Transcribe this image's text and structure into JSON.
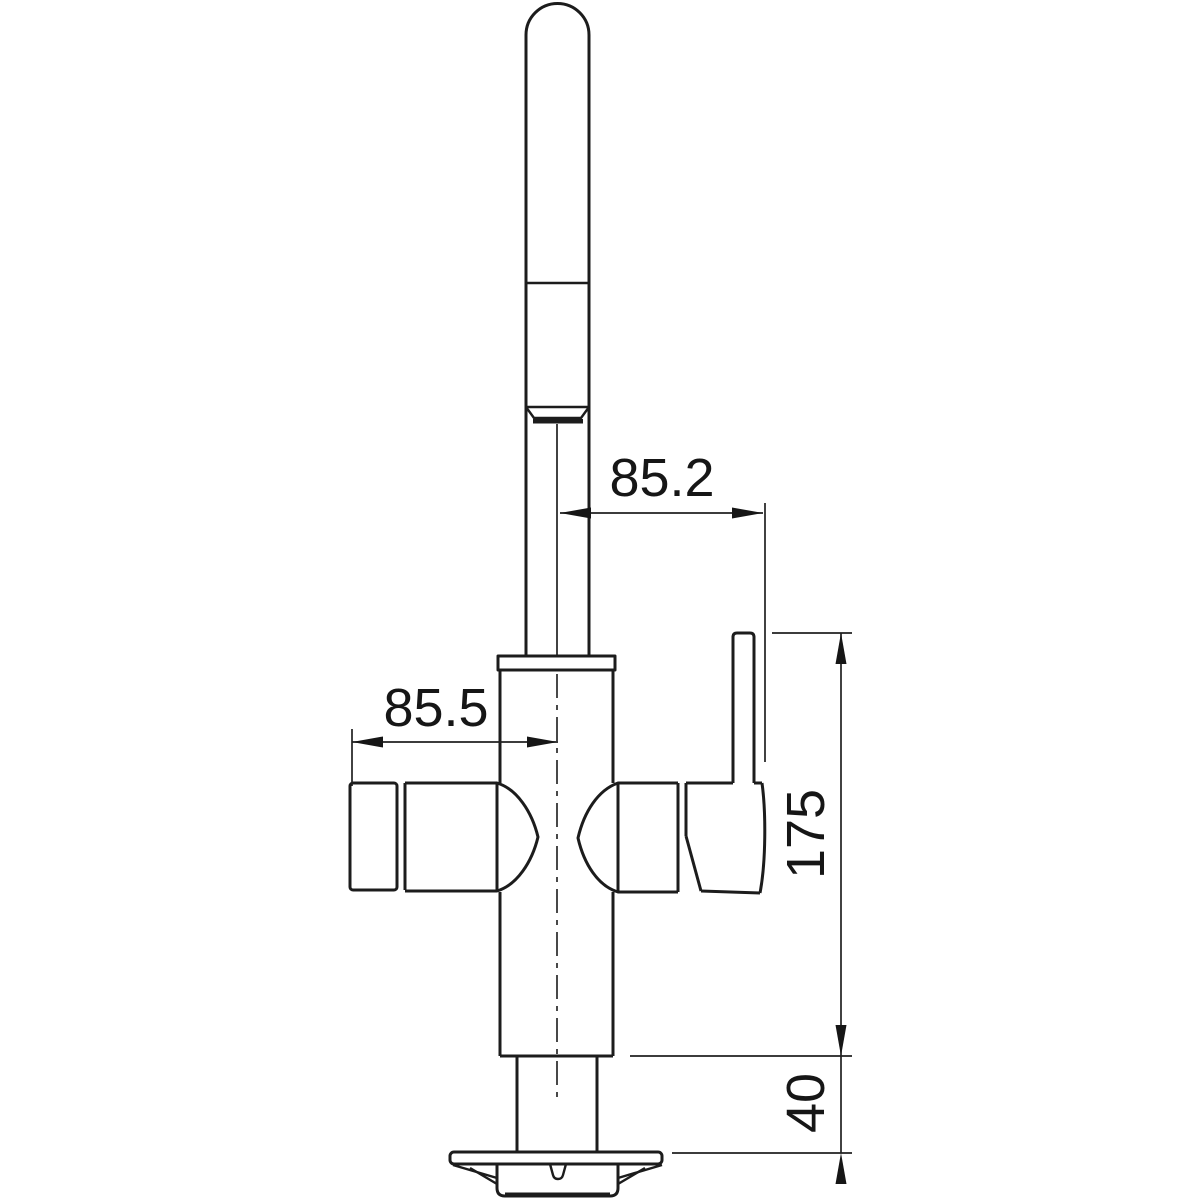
{
  "page": {
    "background": "#ffffff"
  },
  "drawing": {
    "kind": "technical-dimension-drawing",
    "subject": "single-lever kitchen tap, side elevation",
    "line_color": "#1c1c1c",
    "text_color": "#161616",
    "units_shown": false,
    "dimensions": [
      {
        "id": "offset-spout-to-lever",
        "label": "85.2",
        "orientation": "horizontal"
      },
      {
        "id": "offset-valve-to-center",
        "label": "85.5",
        "orientation": "horizontal"
      },
      {
        "id": "height-lever-to-deck",
        "label": "175",
        "orientation": "vertical"
      },
      {
        "id": "deck-section-height",
        "label": "40",
        "orientation": "vertical"
      }
    ]
  }
}
